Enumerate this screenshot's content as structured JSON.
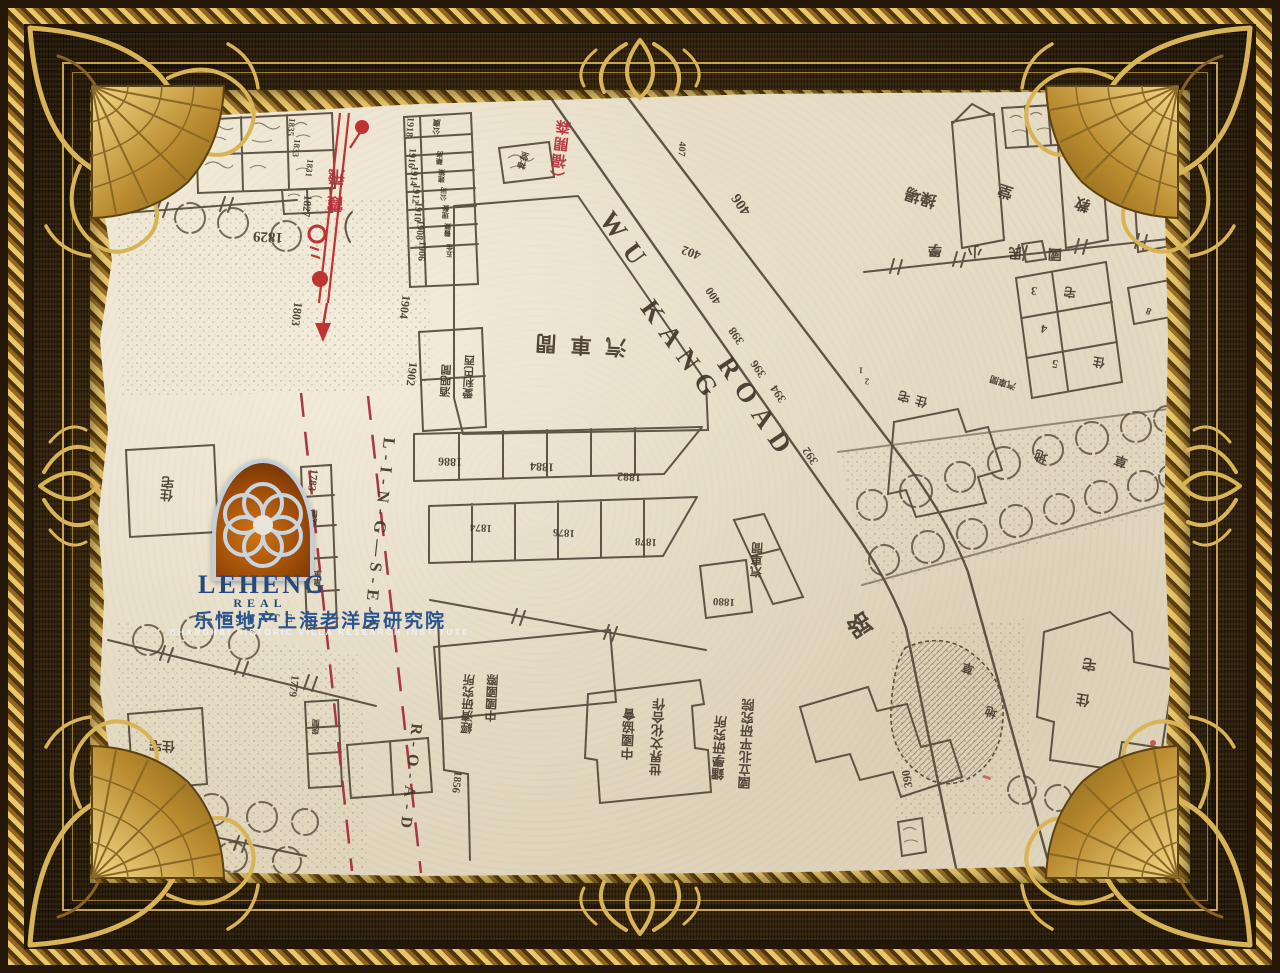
{
  "artwork": {
    "type": "framed historical street map",
    "frame_style": "ornate gold baroque frame on woven brown ground"
  },
  "colors": {
    "frame_gold": "#d9b457",
    "frame_brown": "#3d2a12",
    "paper": "#e8dfc9",
    "ink": "#4d4234",
    "route_red": "#b5303a",
    "logo_blue": "#27497a"
  },
  "logo": {
    "wordmark": "LEHENG",
    "line2": "REAL ESTATE",
    "line3": "乐恒地产上海老洋房研究院",
    "line4": "SHANGHAI HISTORIC VILLA RESEARCH INSTITUTE"
  },
  "roads": {
    "vertical_road": "LING-SEN ROAD",
    "vertical_road_former_name": "霞飛",
    "diagonal_road": "WU KANG ROAD",
    "diagonal_road_former_name": "福開森",
    "road_character": "路"
  },
  "map": {
    "labels": [
      {
        "t": "1829",
        "x": 268,
        "y": 236,
        "r": 183,
        "s": 15
      },
      {
        "t": "1827",
        "x": 306,
        "y": 206,
        "r": 96,
        "s": 11
      },
      {
        "t": "1831",
        "x": 309,
        "y": 168,
        "r": 96,
        "s": 9
      },
      {
        "t": "1833",
        "x": 296,
        "y": 148,
        "r": 96,
        "s": 9
      },
      {
        "t": "1835",
        "x": 291,
        "y": 127,
        "r": 96,
        "s": 9
      },
      {
        "t": "1803",
        "x": 297,
        "y": 314,
        "r": 97,
        "s": 12
      },
      {
        "t": "1918",
        "x": 409,
        "y": 127,
        "r": 94,
        "s": 10
      },
      {
        "t": "1916",
        "x": 411,
        "y": 158,
        "r": 94,
        "s": 10
      },
      {
        "t": "1914",
        "x": 413,
        "y": 176,
        "r": 94,
        "s": 10
      },
      {
        "t": "1912",
        "x": 415,
        "y": 194,
        "r": 94,
        "s": 10
      },
      {
        "t": "1910",
        "x": 417,
        "y": 212,
        "r": 94,
        "s": 10
      },
      {
        "t": "1908",
        "x": 419,
        "y": 230,
        "r": 94,
        "s": 10
      },
      {
        "t": "1906",
        "x": 421,
        "y": 251,
        "r": 94,
        "s": 10
      },
      {
        "t": "1904",
        "x": 405,
        "y": 307,
        "r": 97,
        "s": 12
      },
      {
        "t": "1902",
        "x": 412,
        "y": 374,
        "r": 97,
        "s": 12
      },
      {
        "t": "1886",
        "x": 450,
        "y": 462,
        "r": 183,
        "s": 12
      },
      {
        "t": "1884",
        "x": 542,
        "y": 467,
        "r": 183,
        "s": 12
      },
      {
        "t": "1882",
        "x": 629,
        "y": 477,
        "r": 183,
        "s": 12
      },
      {
        "t": "1874",
        "x": 481,
        "y": 527,
        "r": 183,
        "s": 11
      },
      {
        "t": "1876",
        "x": 564,
        "y": 532,
        "r": 183,
        "s": 11
      },
      {
        "t": "1878",
        "x": 646,
        "y": 541,
        "r": 183,
        "s": 11
      },
      {
        "t": "1880",
        "x": 724,
        "y": 601,
        "r": 183,
        "s": 11
      },
      {
        "t": "1783",
        "x": 312,
        "y": 480,
        "r": 97,
        "s": 11
      },
      {
        "t": "1779",
        "x": 293,
        "y": 686,
        "r": 97,
        "s": 11
      },
      {
        "t": "1856",
        "x": 456,
        "y": 782,
        "r": 97,
        "s": 11
      },
      {
        "t": "406",
        "x": 742,
        "y": 204,
        "r": 236,
        "s": 15
      },
      {
        "t": "402",
        "x": 691,
        "y": 253,
        "r": 200,
        "s": 13
      },
      {
        "t": "400",
        "x": 713,
        "y": 296,
        "r": 236,
        "s": 12
      },
      {
        "t": "398",
        "x": 736,
        "y": 336,
        "r": 236,
        "s": 12
      },
      {
        "t": "396",
        "x": 758,
        "y": 369,
        "r": 236,
        "s": 12
      },
      {
        "t": "394",
        "x": 778,
        "y": 394,
        "r": 236,
        "s": 12
      },
      {
        "t": "392",
        "x": 810,
        "y": 456,
        "r": 236,
        "s": 12
      },
      {
        "t": "390",
        "x": 907,
        "y": 779,
        "r": 260,
        "s": 12
      },
      {
        "t": "407",
        "x": 681,
        "y": 149,
        "r": 94,
        "s": 10
      },
      {
        "t": "3",
        "x": 1034,
        "y": 291,
        "r": 190,
        "s": 12
      },
      {
        "t": "4",
        "x": 1044,
        "y": 329,
        "r": 190,
        "s": 12
      },
      {
        "t": "5",
        "x": 1055,
        "y": 364,
        "r": 190,
        "s": 12
      },
      {
        "t": "宅",
        "x": 1070,
        "y": 292,
        "r": 190,
        "s": 12
      },
      {
        "t": "住",
        "x": 1099,
        "y": 362,
        "r": 190,
        "s": 12
      },
      {
        "t": "1",
        "x": 861,
        "y": 370,
        "r": 183,
        "s": 9
      },
      {
        "t": "2",
        "x": 867,
        "y": 381,
        "r": 183,
        "s": 9
      },
      {
        "t": "8",
        "x": 1149,
        "y": 310,
        "r": 200,
        "s": 10
      },
      {
        "t": "汽車間",
        "x": 574,
        "y": 344,
        "r": 183,
        "s": 21,
        "ls": 14
      },
      {
        "t": "愛利巴西",
        "x": 470,
        "y": 377,
        "r": 183,
        "s": 11,
        "v": true
      },
      {
        "t": "酒吧間",
        "x": 447,
        "y": 381,
        "r": 183,
        "s": 11,
        "v": true
      },
      {
        "t": "住宅",
        "x": 168,
        "y": 489,
        "r": 185,
        "s": 13,
        "v": true
      },
      {
        "t": "住宅",
        "x": 162,
        "y": 746,
        "r": 183,
        "s": 13
      },
      {
        "t": "房間",
        "x": 316,
        "y": 727,
        "r": 183,
        "s": 8,
        "v": true
      },
      {
        "t": "房間",
        "x": 314,
        "y": 518,
        "r": 183,
        "s": 8,
        "v": true
      },
      {
        "t": "單車",
        "x": 318,
        "y": 578,
        "r": 183,
        "s": 8,
        "v": true
      },
      {
        "t": "汽車間",
        "x": 757,
        "y": 560,
        "r": 183,
        "s": 12,
        "v": true
      },
      {
        "t": "汽車間",
        "x": 1003,
        "y": 382,
        "r": 198,
        "s": 9
      },
      {
        "t": "世界文化合作",
        "x": 658,
        "y": 737,
        "r": 183,
        "s": 13,
        "v": true
      },
      {
        "t": "中國協會",
        "x": 629,
        "y": 734,
        "r": 183,
        "s": 13,
        "v": true
      },
      {
        "t": "中國國際",
        "x": 492,
        "y": 698,
        "r": 183,
        "s": 12,
        "v": true
      },
      {
        "t": "經濟研究所",
        "x": 468,
        "y": 704,
        "r": 183,
        "s": 12,
        "v": true
      },
      {
        "t": "國立北平研究院",
        "x": 747,
        "y": 744,
        "r": 183,
        "s": 13,
        "v": true
      },
      {
        "t": "鐳學研究所",
        "x": 720,
        "y": 748,
        "r": 183,
        "s": 13,
        "v": true
      },
      {
        "t": "操場",
        "x": 921,
        "y": 196,
        "r": 198,
        "s": 16
      },
      {
        "t": "堂",
        "x": 1006,
        "y": 190,
        "r": 198,
        "s": 15
      },
      {
        "t": "教",
        "x": 1083,
        "y": 203,
        "r": 198,
        "s": 15
      },
      {
        "t": "國民小學",
        "x": 982,
        "y": 250,
        "r": 182,
        "s": 14,
        "ls": 26
      },
      {
        "t": "住宅",
        "x": 910,
        "y": 398,
        "r": 196,
        "s": 12,
        "ls": 6
      },
      {
        "t": "地",
        "x": 1041,
        "y": 456,
        "r": 200,
        "s": 13
      },
      {
        "t": "草",
        "x": 1121,
        "y": 461,
        "r": 200,
        "s": 13
      },
      {
        "t": "草",
        "x": 968,
        "y": 668,
        "r": 200,
        "s": 12
      },
      {
        "t": "地",
        "x": 991,
        "y": 712,
        "r": 200,
        "s": 12
      },
      {
        "t": "住宅",
        "x": 1090,
        "y": 672,
        "r": 190,
        "s": 14,
        "v": true,
        "ls": 22
      },
      {
        "t": "地",
        "x": 1158,
        "y": 797,
        "r": 200,
        "s": 17
      },
      {
        "t": "路",
        "x": 861,
        "y": 624,
        "r": 236,
        "s": 24
      },
      {
        "t": "霞飛",
        "x": 338,
        "y": 186,
        "r": 183,
        "s": 17,
        "v": true,
        "ls": 10,
        "c": "#b5303a"
      },
      {
        "t": "（福開森",
        "x": 562,
        "y": 152,
        "r": 187,
        "s": 15,
        "v": true,
        "ls": 2,
        "c": "#b5303a"
      },
      {
        "t": "神堂",
        "x": 524,
        "y": 161,
        "r": 198,
        "s": 9,
        "v": true
      },
      {
        "t": "公廣",
        "x": 437,
        "y": 127,
        "r": 183,
        "s": 8,
        "v": true
      },
      {
        "t": "藥房",
        "x": 440,
        "y": 158,
        "r": 183,
        "s": 7,
        "v": true
      },
      {
        "t": "建築",
        "x": 442,
        "y": 176,
        "r": 183,
        "s": 7,
        "v": true
      },
      {
        "t": "公司",
        "x": 444,
        "y": 194,
        "r": 183,
        "s": 7,
        "v": true
      },
      {
        "t": "理髮",
        "x": 446,
        "y": 212,
        "r": 183,
        "s": 7,
        "v": true
      },
      {
        "t": "醫藥",
        "x": 448,
        "y": 230,
        "r": 183,
        "s": 7,
        "v": true
      },
      {
        "t": "五金",
        "x": 450,
        "y": 251,
        "r": 183,
        "s": 7,
        "v": true
      },
      {
        "t": "L-I-N-G—S-E-N",
        "x": 379,
        "y": 537,
        "r": 96,
        "s": 17,
        "ls": 6,
        "c": "#42372a"
      },
      {
        "t": "R-O-A-D",
        "x": 410,
        "y": 779,
        "r": 96,
        "s": 16,
        "ls": 7,
        "c": "#42372a"
      },
      {
        "t": "WU",
        "x": 626,
        "y": 243,
        "r": 54,
        "s": 27,
        "ls": 12,
        "c": "#42372a"
      },
      {
        "t": "KANG",
        "x": 682,
        "y": 352,
        "r": 54,
        "s": 27,
        "ls": 10,
        "c": "#42372a"
      },
      {
        "t": "ROAD",
        "x": 757,
        "y": 409,
        "r": 56,
        "s": 27,
        "ls": 10,
        "c": "#42372a"
      }
    ]
  }
}
